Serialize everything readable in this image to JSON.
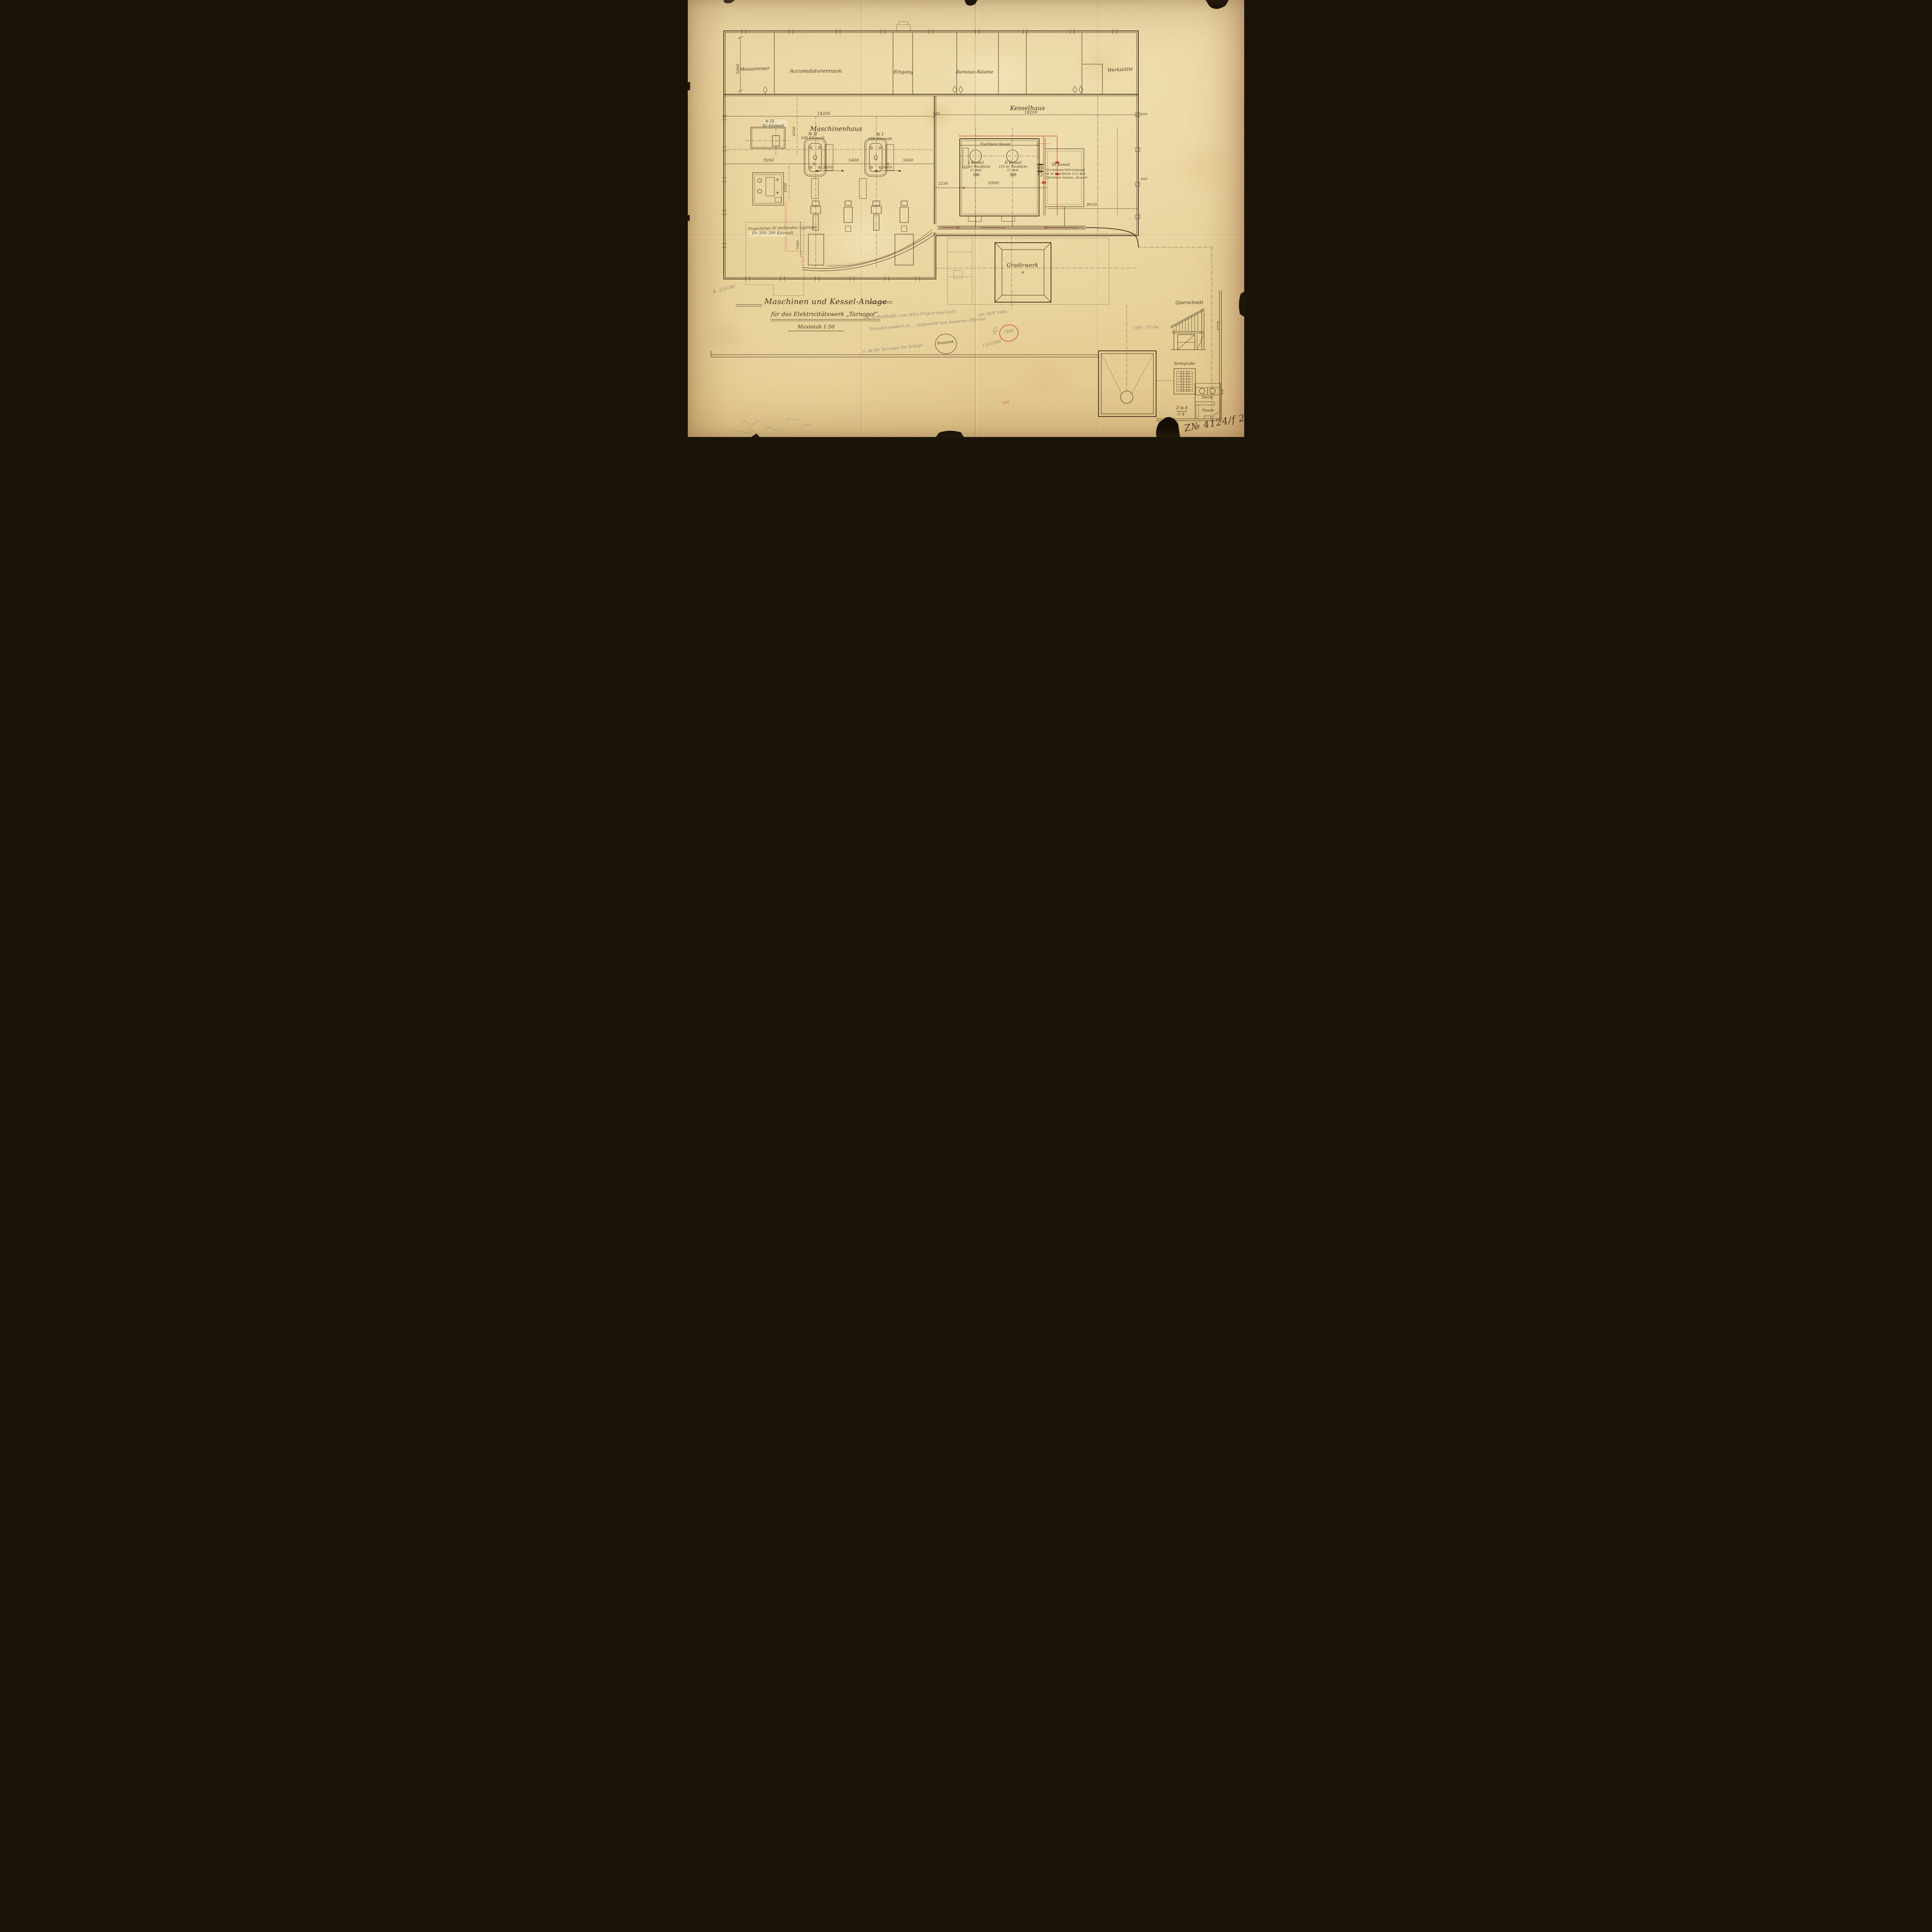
{
  "colors": {
    "paper": "#e9d5a2",
    "ink": "#45361f",
    "red_ink": "#c6402e",
    "pencil": "#8f8773",
    "red_pencil": "#cc5146"
  },
  "title_block": {
    "line1": "Maschinen und Kessel-Anlage",
    "line2": "für das Elektricitätswerk „Tarnopol“.",
    "scale": "Massstab 1:50"
  },
  "rooms": {
    "messzimmer": "Messzimmer",
    "accumulatorenraum": "Accumulatorenraum",
    "eingang": "Eingang",
    "bureaux": "Bureaux-Räume",
    "werkstaette": "Werkstätte"
  },
  "halls": {
    "maschinenhaus": "Maschinenhaus",
    "kesselhaus": "Kesselhaus"
  },
  "machines": {
    "m2_no": "№ II",
    "m2_power": "100 Kilowatt",
    "m1_no": "№ I",
    "m1_power": "100 Kilowatt",
    "m3_no": "№ III",
    "m3_power": "82 Kilowatt",
    "projected_line1": "Projectirtes IV stehendes Aggregat",
    "projected_line2": "für 200–300 Kilowatt"
  },
  "boilers": {
    "maker": "Tischbein Kessel",
    "k1_name": "I Kessel",
    "k1_area": "115 m² Heizfläche",
    "k1_pressure": "11 Atm.",
    "k2_name": "II Kessel",
    "k2_area": "115 m² Heizfläche",
    "k2_pressure": "11 Atm.",
    "k3_name": "III Kessel",
    "k3_type": "Circulations-Röhrenkessel",
    "k3_area": "91 m² Heizfläche 12,5 Atm.",
    "k3_superheater": "Überhitzer System „Kausch“"
  },
  "site": {
    "gradirwerk": "Gradirwerk",
    "querschnitt": "Querschnitt",
    "senkgrube": "Senkgrube",
    "aborte": "Aborte",
    "pissoir": "Pissoir",
    "sheet_no": "Z № 8",
    "sheet_sub": "C 4"
  },
  "dimensions": {
    "d18200_machine": "18200",
    "d18200_boiler": "18200",
    "d400": "400",
    "d600_a": "600",
    "d600_b": "600",
    "d5000": "5000",
    "d9200": "9200",
    "d5400": "5400",
    "d3600": "3600",
    "d2600_a": "2600",
    "d2600_b": "2600",
    "d4500_a": "4500",
    "d4500_b": "4500",
    "d2250": "2250",
    "d6900": "6900",
    "d9050": "9050",
    "d7000": "7000"
  },
  "annotations": {
    "pencil_price": "K. 220·00",
    "pencil_measure": "109 – 73 Oe",
    "faint_line1": "Die Schnellhefte zum März Project sind nicht",
    "faint_line2": "Tarnopol sondern in … aufgestellt laut äusseren Offerten",
    "date_note": "am 28/V 1904",
    "faint_line3": "u. ist für Tarnopol die Anlage …",
    "file_number": "13/32906",
    "date_fraction_num": "11",
    "date_fraction_den": "V",
    "date_circled": "1904",
    "red_note": "600",
    "registry_number": "Z№ 4124/f 2.",
    "oval_stamp": "Brusánek"
  }
}
